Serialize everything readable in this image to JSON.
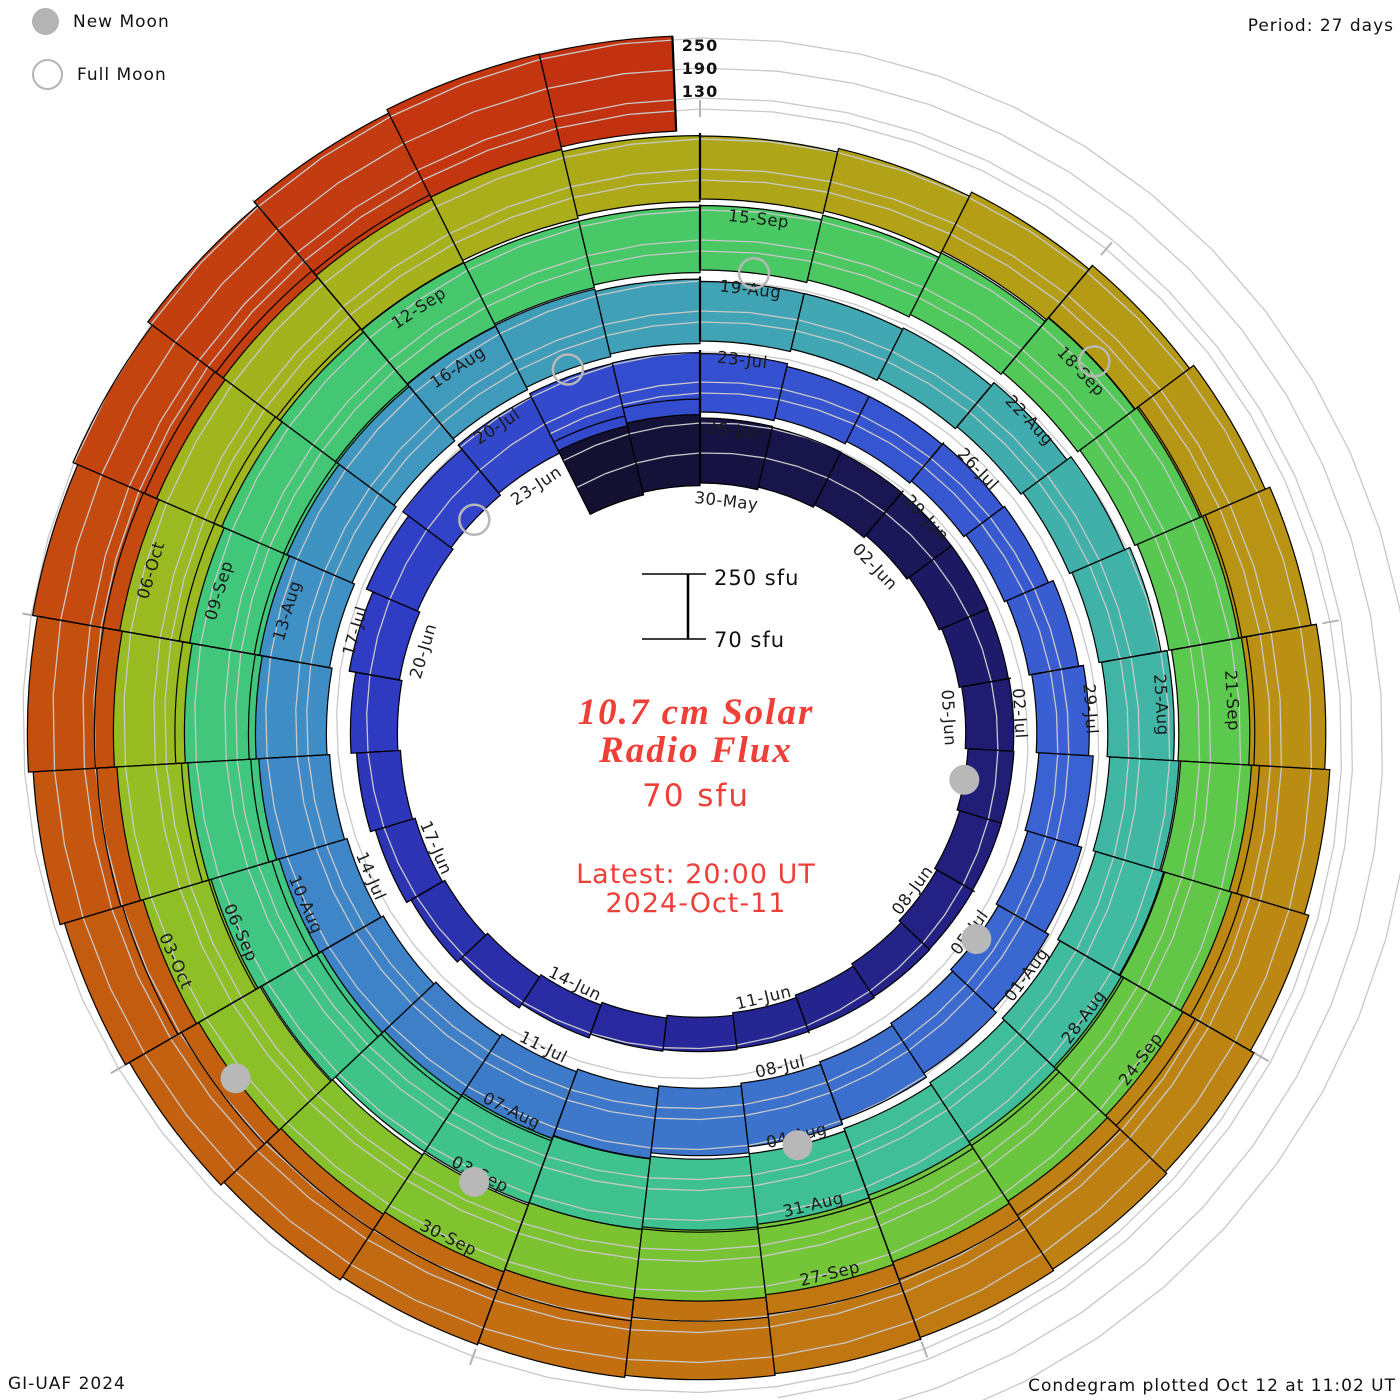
{
  "legend": {
    "new_moon": "New Moon",
    "full_moon": "Full Moon"
  },
  "period_label": "Period: 27 days",
  "radial_axis": {
    "labels": [
      "250",
      "190",
      "130"
    ]
  },
  "center": {
    "title_line1": "10.7 cm Solar",
    "title_line2": "Radio Flux",
    "latest_flux": "70 sfu",
    "latest_line1": "Latest: 20:00 UT",
    "latest_line2": "2024-Oct-11",
    "scale_top": "250 sfu",
    "scale_bottom": "70 sfu",
    "accent_color": "#ee3f38"
  },
  "footer": {
    "credit": "GI-UAF 2024",
    "plotted": "Condegram plotted Oct 12 at 11:02 UT"
  },
  "chart_data": {
    "type": "bar",
    "subtype": "condegram-spiral",
    "title": "10.7 cm Solar Radio Flux",
    "units": "sfu",
    "period_days": 27,
    "days_per_tick": 3,
    "start_date": "2024-05-28",
    "end_date": "2024-10-11",
    "revolution_start_labels": [
      "30-May",
      "26-Jun",
      "23-Jul",
      "19-Aug",
      "15-Sep"
    ],
    "flux_baseline_sfu": 70,
    "flux_axis_max_sfu": 250,
    "grid_levels_sfu": [
      130,
      190,
      250
    ],
    "values_sfu": [
      232,
      243,
      200,
      193,
      187,
      181,
      176,
      170,
      166,
      162,
      157,
      153,
      149,
      146,
      142,
      139,
      137,
      140,
      144,
      148,
      153,
      158,
      164,
      172,
      181,
      190,
      196,
      198,
      194,
      187,
      176,
      171,
      168,
      166,
      171,
      175,
      179,
      183,
      186,
      190,
      194,
      198,
      205,
      211,
      217,
      221,
      224,
      227,
      228,
      226,
      223,
      219,
      216,
      213,
      209,
      199,
      189,
      184,
      182,
      185,
      190,
      196,
      203,
      209,
      214,
      217,
      221,
      222,
      220,
      216,
      212,
      208,
      204,
      209,
      217,
      225,
      231,
      233,
      229,
      221,
      213,
      206,
      201,
      199,
      203,
      208,
      213,
      216,
      218,
      222,
      228,
      234,
      241,
      246,
      249,
      251,
      252,
      254,
      253,
      250,
      252,
      255,
      253,
      250,
      246,
      238,
      230,
      222,
      212,
      202,
      196,
      198,
      202,
      207,
      212,
      217,
      222,
      227,
      231,
      234,
      233,
      231,
      229,
      227,
      226,
      225,
      227,
      230,
      234,
      238,
      242,
      247,
      252,
      258,
      263,
      266,
      260
    ],
    "date_labels": [
      {
        "i": 2,
        "label": "30-May"
      },
      {
        "i": 5,
        "label": "02-Jun"
      },
      {
        "i": 8,
        "label": "05-Jun"
      },
      {
        "i": 11,
        "label": "08-Jun"
      },
      {
        "i": 14,
        "label": "11-Jun"
      },
      {
        "i": 17,
        "label": "14-Jun"
      },
      {
        "i": 20,
        "label": "17-Jun"
      },
      {
        "i": 23,
        "label": "20-Jun"
      },
      {
        "i": 26,
        "label": "23-Jun"
      },
      {
        "i": 29,
        "label": "26-Jun"
      },
      {
        "i": 32,
        "label": "29-Jun"
      },
      {
        "i": 35,
        "label": "02-Jul"
      },
      {
        "i": 38,
        "label": "05-Jul"
      },
      {
        "i": 41,
        "label": "08-Jul"
      },
      {
        "i": 44,
        "label": "11-Jul"
      },
      {
        "i": 47,
        "label": "14-Jul"
      },
      {
        "i": 50,
        "label": "17-Jul"
      },
      {
        "i": 53,
        "label": "20-Jul"
      },
      {
        "i": 56,
        "label": "23-Jul"
      },
      {
        "i": 59,
        "label": "26-Jul"
      },
      {
        "i": 62,
        "label": "29-Jul"
      },
      {
        "i": 65,
        "label": "01-Aug"
      },
      {
        "i": 68,
        "label": "04-Aug"
      },
      {
        "i": 71,
        "label": "07-Aug"
      },
      {
        "i": 74,
        "label": "10-Aug"
      },
      {
        "i": 77,
        "label": "13-Aug"
      },
      {
        "i": 80,
        "label": "16-Aug"
      },
      {
        "i": 83,
        "label": "19-Aug"
      },
      {
        "i": 86,
        "label": "22-Aug"
      },
      {
        "i": 89,
        "label": "25-Aug"
      },
      {
        "i": 92,
        "label": "28-Aug"
      },
      {
        "i": 95,
        "label": "31-Aug"
      },
      {
        "i": 98,
        "label": "03-Sep"
      },
      {
        "i": 101,
        "label": "06-Sep"
      },
      {
        "i": 104,
        "label": "09-Sep"
      },
      {
        "i": 107,
        "label": "12-Sep"
      },
      {
        "i": 110,
        "label": "15-Sep"
      },
      {
        "i": 113,
        "label": "18-Sep"
      },
      {
        "i": 116,
        "label": "21-Sep"
      },
      {
        "i": 119,
        "label": "24-Sep"
      },
      {
        "i": 122,
        "label": "27-Sep"
      },
      {
        "i": 125,
        "label": "30-Sep"
      },
      {
        "i": 128,
        "label": "03-Oct"
      },
      {
        "i": 131,
        "label": "06-Oct"
      }
    ],
    "moons": {
      "new": [
        {
          "date": "2024-06-06",
          "i": 9
        },
        {
          "date": "2024-07-05",
          "i": 38
        },
        {
          "date": "2024-08-04",
          "i": 68
        },
        {
          "date": "2024-09-03",
          "i": 98
        },
        {
          "date": "2024-10-02",
          "i": 127
        }
      ],
      "full": [
        {
          "date": "2024-06-22",
          "i": 25
        },
        {
          "date": "2024-07-21",
          "i": 54
        },
        {
          "date": "2024-08-19",
          "i": 83
        },
        {
          "date": "2024-09-18",
          "i": 113
        }
      ]
    },
    "colormap": [
      {
        "i": 0,
        "color": "#131032"
      },
      {
        "i": 8,
        "color": "#201c72"
      },
      {
        "i": 16,
        "color": "#28299e"
      },
      {
        "i": 23,
        "color": "#2f3dc4"
      },
      {
        "i": 29,
        "color": "#3550d0"
      },
      {
        "i": 36,
        "color": "#3a62d2"
      },
      {
        "i": 43,
        "color": "#3d78ca"
      },
      {
        "i": 50,
        "color": "#3f90c4"
      },
      {
        "i": 57,
        "color": "#41a7b2"
      },
      {
        "i": 64,
        "color": "#40baa0"
      },
      {
        "i": 70,
        "color": "#3fc28e"
      },
      {
        "i": 77,
        "color": "#41c779"
      },
      {
        "i": 84,
        "color": "#4cc860"
      },
      {
        "i": 90,
        "color": "#5ec84a"
      },
      {
        "i": 96,
        "color": "#78c434"
      },
      {
        "i": 102,
        "color": "#94be24"
      },
      {
        "i": 108,
        "color": "#aaae1a"
      },
      {
        "i": 113,
        "color": "#b59a15"
      },
      {
        "i": 118,
        "color": "#bc8813"
      },
      {
        "i": 123,
        "color": "#c17311"
      },
      {
        "i": 128,
        "color": "#c45c10"
      },
      {
        "i": 132,
        "color": "#c44410"
      },
      {
        "i": 136,
        "color": "#c23110"
      }
    ],
    "style_colors": {
      "grid": "#c8c8c8",
      "tick": "#b3b3b3",
      "bar_outline": "#000000",
      "moon": "#b8b8b8",
      "date_label": "#1b1b1b"
    },
    "legend_position": "top-left",
    "grid": true
  }
}
